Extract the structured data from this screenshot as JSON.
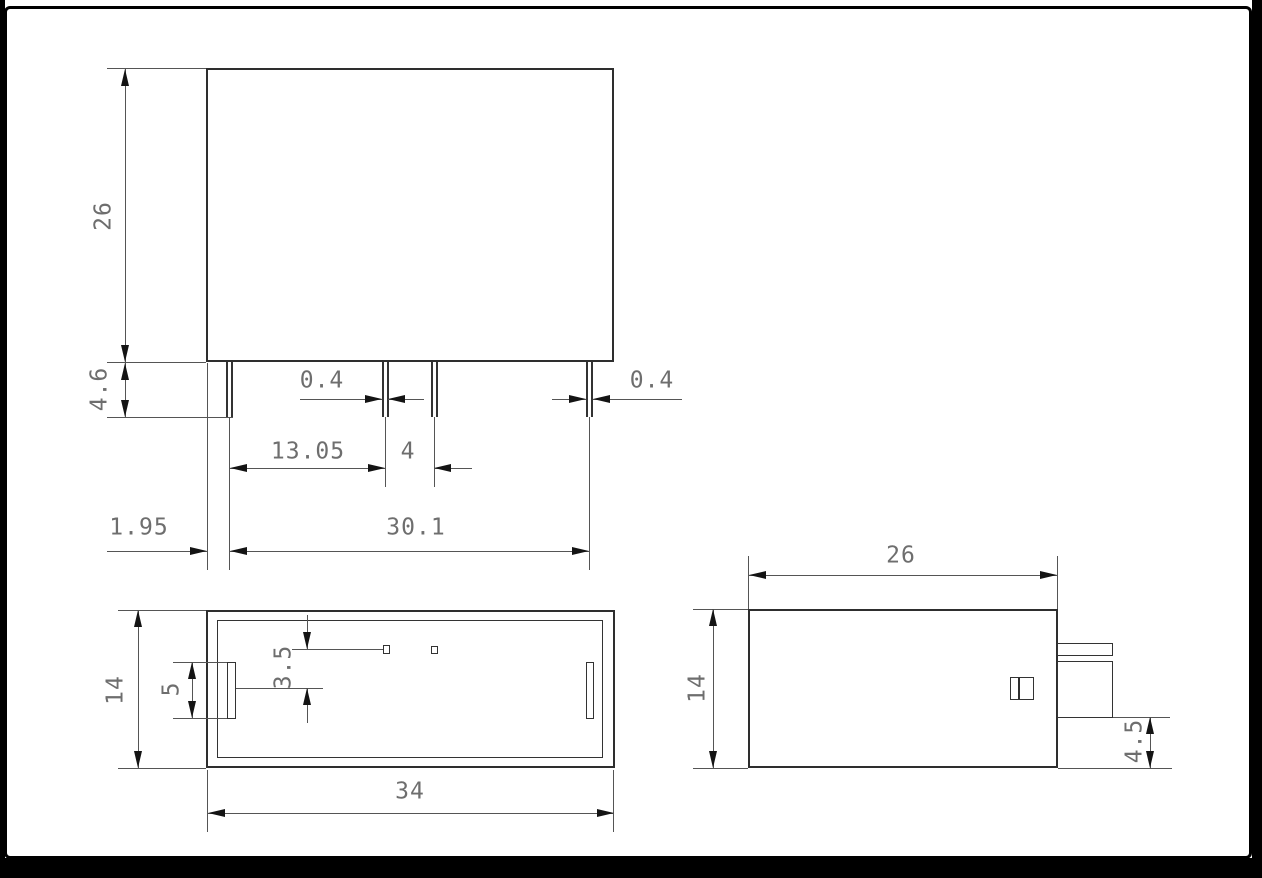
{
  "page": {
    "background": "#ffffff",
    "frame_color": "#000000",
    "object_line_color": "#2e2e2e",
    "dimension_line_color": "#555555",
    "dimension_text_color": "#6e6e6e"
  },
  "views": {
    "front": {
      "dims": {
        "height": "26",
        "pin_length": "4.6",
        "pin_width_mid": "0.4",
        "pin_width_right": "0.4",
        "pin_pitch_a": "13.05",
        "pin_pitch_b": "4",
        "pin_span": "30.1",
        "edge_to_pin": "1.95"
      }
    },
    "bottom": {
      "dims": {
        "width": "14",
        "slot_length": "5",
        "pin_row_offset": "3.5",
        "length": "34"
      }
    },
    "side": {
      "dims": {
        "length": "26",
        "height": "14",
        "step_height": "4.5"
      }
    }
  }
}
